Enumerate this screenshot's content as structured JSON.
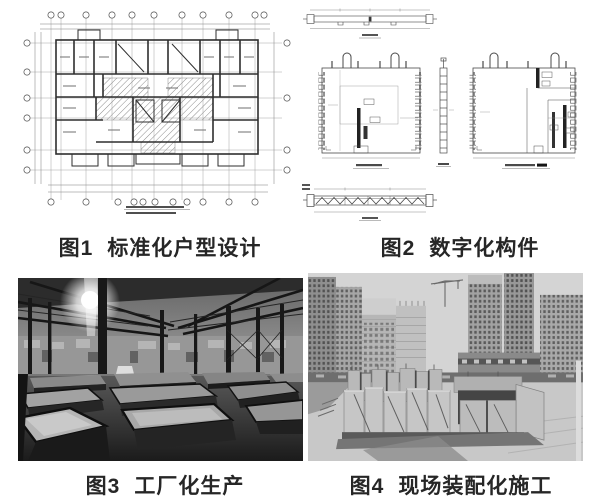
{
  "page": {
    "background": "#ffffff",
    "caption_color": "#262626"
  },
  "figures": [
    {
      "label": "图1",
      "title": "标准化户型设计",
      "kind": "line-drawing",
      "alt": "standardized residential unit floor plan drawing"
    },
    {
      "label": "图2",
      "title": "数字化构件",
      "kind": "line-drawing",
      "alt": "digitalized precast component shop drawings"
    },
    {
      "label": "图3",
      "title": "工厂化生产",
      "kind": "photo",
      "alt": "factory interior with precast casting tables"
    },
    {
      "label": "图4",
      "title": "现场装配化施工",
      "kind": "photo",
      "alt": "construction site with assembled precast walls and towers"
    }
  ],
  "colors": {
    "drawing_line": "#3f3f3f",
    "drawing_dim": "#8a8a8a",
    "photo_dark": "#1c1c1c",
    "photo_light": "#d4d4d4"
  }
}
